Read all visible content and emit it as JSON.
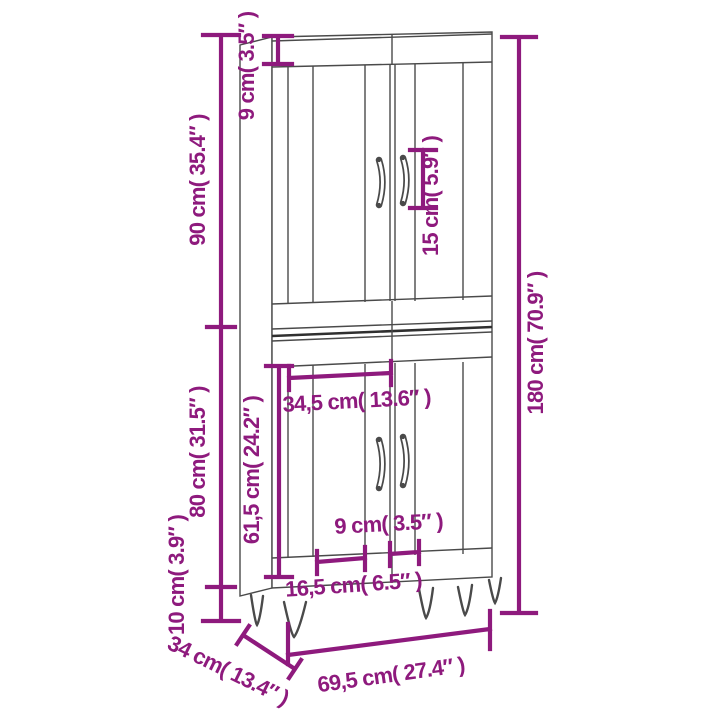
{
  "diagram": {
    "alt": "dimension drawing of a tall two-section cabinet with four slatted doors, curved handles and hairpin legs"
  },
  "colors": {
    "dimension_accent": "#8E1A7D",
    "outline": "#4A4A4A",
    "junction_shadow": "#2F2F2F",
    "background": "#FFFFFF"
  },
  "labels": {
    "top_panel_height": "9 cm( 3.5″ )",
    "upper_unit_height": "90 cm( 35.4″ )",
    "handle_length": "15 cm( 5.9″ )",
    "total_height": "180 cm( 70.9″ )",
    "lower_door_width": "34,5 cm( 13.6″ )",
    "lower_unit_height": "80 cm( 31.5″ )",
    "lower_door_height": "61,5 cm( 24.2″ )",
    "handle_spacing": "9 cm( 3.5″ )",
    "leg_height": "10 cm( 3.9″ )",
    "bottom_gap_width": "16,5 cm( 6.5″ )",
    "depth": "34 cm( 13.4″ )",
    "width": "69,5 cm( 27.4″ )"
  }
}
